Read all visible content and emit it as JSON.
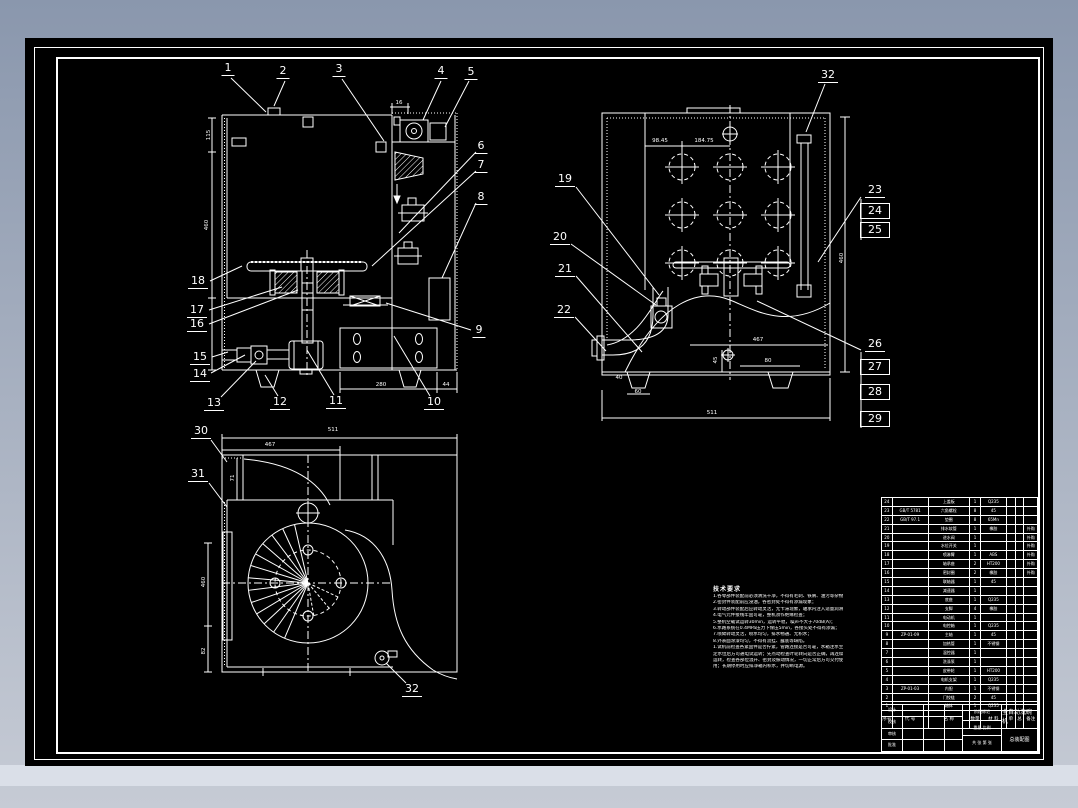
{
  "colors": {
    "bg_top": "#8a97ad",
    "bg_bottom": "#c6cbd5",
    "paper": "#000000",
    "line": "#ffffff",
    "band": "#dadfe8"
  },
  "callouts": [
    {
      "label": "1",
      "x": 228,
      "y": 62,
      "leader": [
        231,
        78,
        266,
        112
      ]
    },
    {
      "label": "2",
      "x": 283,
      "y": 65,
      "leader": [
        285,
        81,
        274,
        106
      ]
    },
    {
      "label": "3",
      "x": 339,
      "y": 63,
      "leader": [
        342,
        79,
        384,
        141
      ]
    },
    {
      "label": "4",
      "x": 441,
      "y": 65,
      "leader": [
        441,
        81,
        423,
        120
      ]
    },
    {
      "label": "5",
      "x": 471,
      "y": 66,
      "leader": [
        469,
        81,
        445,
        127
      ]
    },
    {
      "label": "6",
      "x": 481,
      "y": 140,
      "leader": [
        476,
        152,
        399,
        233
      ]
    },
    {
      "label": "7",
      "x": 481,
      "y": 159,
      "leader": [
        476,
        171,
        372,
        266
      ]
    },
    {
      "label": "8",
      "x": 481,
      "y": 191,
      "leader": [
        476,
        203,
        442,
        278
      ]
    },
    {
      "label": "9",
      "x": 479,
      "y": 324,
      "leader": [
        471,
        330,
        386,
        303
      ]
    },
    {
      "label": "10",
      "x": 434,
      "y": 396,
      "leader": [
        430,
        396,
        394,
        336
      ]
    },
    {
      "label": "11",
      "x": 336,
      "y": 395,
      "leader": [
        334,
        395,
        307,
        350
      ]
    },
    {
      "label": "12",
      "x": 280,
      "y": 396,
      "leader": [
        278,
        396,
        265,
        375
      ]
    },
    {
      "label": "13",
      "x": 214,
      "y": 397,
      "leader": [
        221,
        397,
        256,
        361
      ]
    },
    {
      "label": "14",
      "x": 200,
      "y": 368,
      "leader": [
        211,
        373,
        245,
        355
      ]
    },
    {
      "label": "15",
      "x": 200,
      "y": 351,
      "leader": [
        212,
        357,
        228,
        352
      ]
    },
    {
      "label": "16",
      "x": 197,
      "y": 318,
      "leader": [
        209,
        324,
        298,
        290
      ]
    },
    {
      "label": "17",
      "x": 197,
      "y": 304,
      "leader": [
        209,
        310,
        282,
        287
      ]
    },
    {
      "label": "18",
      "x": 198,
      "y": 275,
      "leader": [
        210,
        281,
        242,
        266
      ]
    },
    {
      "label": "19",
      "x": 565,
      "y": 173,
      "leader": [
        576,
        187,
        659,
        295
      ]
    },
    {
      "label": "20",
      "x": 560,
      "y": 231,
      "leader": [
        571,
        244,
        656,
        305
      ]
    },
    {
      "label": "21",
      "x": 565,
      "y": 263,
      "leader": [
        576,
        276,
        642,
        352
      ]
    },
    {
      "label": "22",
      "x": 564,
      "y": 304,
      "leader": [
        575,
        317,
        606,
        351
      ]
    },
    {
      "label": "23",
      "x": 875,
      "y": 184,
      "leader": [
        861,
        197,
        818,
        262
      ]
    },
    {
      "label": "24",
      "x": 875,
      "y": 203,
      "box": true
    },
    {
      "label": "25",
      "x": 875,
      "y": 222,
      "box": true
    },
    {
      "label": "26",
      "x": 875,
      "y": 338,
      "leader": [
        861,
        350,
        757,
        301
      ]
    },
    {
      "label": "27",
      "x": 875,
      "y": 359,
      "box": true
    },
    {
      "label": "28",
      "x": 875,
      "y": 384,
      "box": true
    },
    {
      "label": "29",
      "x": 875,
      "y": 411,
      "box": true
    },
    {
      "label": "32",
      "x": 828,
      "y": 69,
      "leader": [
        825,
        84,
        806,
        132
      ]
    },
    {
      "label": "30",
      "x": 201,
      "y": 425,
      "leader": [
        211,
        440,
        227,
        462
      ]
    },
    {
      "label": "31",
      "x": 198,
      "y": 468,
      "leader": [
        209,
        483,
        227,
        507
      ]
    },
    {
      "label": "32",
      "x": 412,
      "y": 683,
      "leader": [
        406,
        683,
        386,
        663
      ]
    }
  ],
  "dimensions": [
    {
      "label": "16",
      "x": 399,
      "y": 103
    },
    {
      "label": "280",
      "x": 381,
      "y": 385
    },
    {
      "label": "44",
      "x": 446,
      "y": 385
    },
    {
      "label": "115",
      "x": 209,
      "y": 135,
      "rot": true
    },
    {
      "label": "460",
      "x": 207,
      "y": 225,
      "rot": true
    },
    {
      "label": "98.45",
      "x": 660,
      "y": 141
    },
    {
      "label": "184.75",
      "x": 704,
      "y": 141
    },
    {
      "label": "467",
      "x": 758,
      "y": 340
    },
    {
      "label": "80",
      "x": 768,
      "y": 361
    },
    {
      "label": "45",
      "x": 716,
      "y": 360,
      "rot": true
    },
    {
      "label": "40",
      "x": 619,
      "y": 378
    },
    {
      "label": "60",
      "x": 638,
      "y": 392
    },
    {
      "label": "511",
      "x": 712,
      "y": 413
    },
    {
      "label": "460",
      "x": 842,
      "y": 258,
      "rot": true
    },
    {
      "label": "511",
      "x": 333,
      "y": 430
    },
    {
      "label": "467",
      "x": 270,
      "y": 445
    },
    {
      "label": "71",
      "x": 233,
      "y": 478,
      "rot": true
    },
    {
      "label": "460",
      "x": 204,
      "y": 582,
      "rot": true
    },
    {
      "label": "82",
      "x": 204,
      "y": 651,
      "rot": true
    }
  ],
  "notes": {
    "title": "技术要求",
    "lines": [
      "1.各零部件装配前必须清洗干净，不得有毛刺、铁屑、油污等杂物；",
      "2.密封件装配前应浸油，各密封处不得有渗漏现象；",
      "3.转动部件装配后应转动灵活，无卡滞现象，轴承内注入适量润滑脂；",
      "4.电气元件接线牢固可靠，整机须作绝缘检查；",
      "5.整机空载试运转30min，运转平稳，噪声不大于70dB(A)；",
      "6.水路系统在0.4MPa压力下保压5min，各接头处不得有渗漏；",
      "7.喷臂转动灵活，喷水均匀，排水畅通、无积水；",
      "8.外表面涂漆均匀，不得有流挂、露底等缺陷。",
      "",
      "1.试机前检查各紧固件是否拧紧，管路连接是否可靠，水箱注水至规",
      "  定水位后方可通电试运转；先点动检查叶轮转向是否正确，再连续",
      "  运转，检查各部位温升、密封及振动情况，一切正常后方可交付使",
      "  用；长期停用时应排净箱内积水，并切断电源。"
    ]
  },
  "bom": {
    "headers": [
      "序号",
      "代  号",
      "名  称",
      "数量",
      "材  料",
      "单件",
      "总计",
      "备注"
    ],
    "weight_group": "重  量",
    "rows": [
      {
        "no": "24",
        "code": "",
        "name": "上盖板",
        "qty": "1",
        "mat": "Q235",
        "w1": "",
        "w2": "",
        "rem": ""
      },
      {
        "no": "23",
        "code": "GB/T 5781",
        "name": "六角螺栓",
        "qty": "8",
        "mat": "45",
        "w1": "",
        "w2": "",
        "rem": ""
      },
      {
        "no": "22",
        "code": "GB/T 97.1",
        "name": "垫圈",
        "qty": "8",
        "mat": "65Mn",
        "w1": "",
        "w2": "",
        "rem": ""
      },
      {
        "no": "21",
        "code": "",
        "name": "排水软管",
        "qty": "1",
        "mat": "橡胶",
        "w1": "",
        "w2": "",
        "rem": "外购"
      },
      {
        "no": "20",
        "code": "",
        "name": "进水阀",
        "qty": "1",
        "mat": "",
        "w1": "",
        "w2": "",
        "rem": "外购"
      },
      {
        "no": "19",
        "code": "",
        "name": "水位开关",
        "qty": "1",
        "mat": "",
        "w1": "",
        "w2": "",
        "rem": "外购"
      },
      {
        "no": "18",
        "code": "",
        "name": "喷淋臂",
        "qty": "1",
        "mat": "ABS",
        "w1": "",
        "w2": "",
        "rem": "外购"
      },
      {
        "no": "17",
        "code": "",
        "name": "轴承座",
        "qty": "2",
        "mat": "HT200",
        "w1": "",
        "w2": "",
        "rem": "外购"
      },
      {
        "no": "16",
        "code": "",
        "name": "密封圈",
        "qty": "2",
        "mat": "橡胶",
        "w1": "",
        "w2": "",
        "rem": "外购"
      },
      {
        "no": "15",
        "code": "",
        "name": "联轴器",
        "qty": "1",
        "mat": "45",
        "w1": "",
        "w2": "",
        "rem": ""
      },
      {
        "no": "14",
        "code": "",
        "name": "减速器",
        "qty": "1",
        "mat": "",
        "w1": "",
        "w2": "",
        "rem": ""
      },
      {
        "no": "13",
        "code": "",
        "name": "底座",
        "qty": "1",
        "mat": "Q235",
        "w1": "",
        "w2": "",
        "rem": ""
      },
      {
        "no": "12",
        "code": "",
        "name": "支脚",
        "qty": "4",
        "mat": "橡胶",
        "w1": "",
        "w2": "",
        "rem": ""
      },
      {
        "no": "11",
        "code": "",
        "name": "电动机",
        "qty": "1",
        "mat": "",
        "w1": "",
        "w2": "",
        "rem": ""
      },
      {
        "no": "10",
        "code": "",
        "name": "电控箱",
        "qty": "1",
        "mat": "Q235",
        "w1": "",
        "w2": "",
        "rem": ""
      },
      {
        "no": "9",
        "code": "ZP-01-09",
        "name": "主轴",
        "qty": "1",
        "mat": "45",
        "w1": "",
        "w2": "",
        "rem": ""
      },
      {
        "no": "8",
        "code": "",
        "name": "加热管",
        "qty": "1",
        "mat": "不锈钢",
        "w1": "",
        "w2": "",
        "rem": ""
      },
      {
        "no": "7",
        "code": "",
        "name": "温控器",
        "qty": "1",
        "mat": "",
        "w1": "",
        "w2": "",
        "rem": ""
      },
      {
        "no": "6",
        "code": "",
        "name": "洗涤泵",
        "qty": "1",
        "mat": "",
        "w1": "",
        "w2": "",
        "rem": ""
      },
      {
        "no": "5",
        "code": "",
        "name": "皮带轮",
        "qty": "1",
        "mat": "HT200",
        "w1": "",
        "w2": "",
        "rem": ""
      },
      {
        "no": "4",
        "code": "",
        "name": "电机支架",
        "qty": "1",
        "mat": "Q235",
        "w1": "",
        "w2": "",
        "rem": ""
      },
      {
        "no": "3",
        "code": "ZP-01-03",
        "name": "内胆",
        "qty": "1",
        "mat": "不锈钢",
        "w1": "",
        "w2": "",
        "rem": ""
      },
      {
        "no": "2",
        "code": "",
        "name": "门铰链",
        "qty": "2",
        "mat": "45",
        "w1": "",
        "w2": "",
        "rem": ""
      },
      {
        "no": "1",
        "code": "",
        "name": "箱体",
        "qty": "1",
        "mat": "Q235",
        "w1": "",
        "w2": "",
        "rem": ""
      }
    ]
  },
  "title_block": {
    "left_rows": [
      [
        "设计",
        "",
        "",
        ""
      ],
      [
        "校核",
        "",
        "",
        ""
      ],
      [
        "审核",
        "",
        "",
        ""
      ],
      [
        "批准",
        "",
        "",
        ""
      ]
    ],
    "stage": "阶段标记",
    "weight": "重量",
    "scale": "比例",
    "sheet": "共 张  第 张",
    "name1": "全自动洗碗机",
    "name2": "总装配图"
  }
}
